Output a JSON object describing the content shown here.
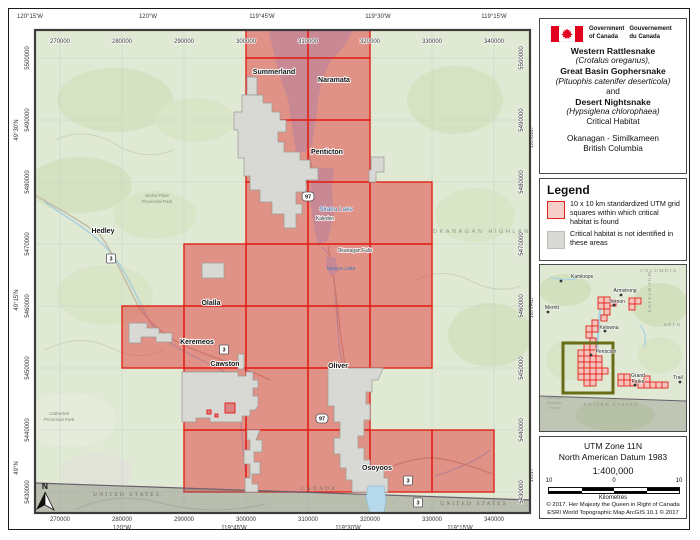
{
  "header": {
    "gov_en_1": "Government",
    "gov_en_2": "of Canada",
    "gov_fr_1": "Gouvernement",
    "gov_fr_2": "du Canada"
  },
  "title": {
    "lines": [
      "Western Rattlesnake",
      "(Crotalus oreganus),",
      "Great Basin Gophersnake",
      "(Pituophis catenifer deserticola)",
      "and",
      "Desert Nightsnake",
      "(Hypsiglena chlorophaea)",
      "Critical Habitat",
      "Okanagan - Similkameen",
      "British Columbia"
    ]
  },
  "legend": {
    "heading": "Legend",
    "item1": "10 x 10 km standardized UTM grid squares within which critical habitat is found",
    "item2": "Critical habitat is not identified in these areas"
  },
  "projection": {
    "line1": "UTM Zone 11N",
    "line2": "North American Datum 1983",
    "scale": "1:400,000",
    "scale_left": "10",
    "scale_mid": "0",
    "scale_right": "10",
    "scale_unit": "Kilometres",
    "copyright1": "© 2017. Her Majesty the Queen in Right of Canada",
    "copyright2": "ESRI World Topographic Map ArcGIS 10.1 © 2017"
  },
  "map": {
    "eastings": [
      "270000",
      "280000",
      "290000",
      "300000",
      "310000",
      "320000",
      "330000",
      "340000"
    ],
    "northings": [
      "5500000",
      "5490000",
      "5480000",
      "5470000",
      "5460000",
      "5450000",
      "5440000",
      "5430000"
    ],
    "lons_top": [
      "120°15'W",
      "120°W",
      "119°45'W",
      "119°30'W",
      "119°15'W"
    ],
    "lons_bottom": [
      "120°W",
      "119°45'W",
      "119°30'W",
      "119°15'W"
    ],
    "lats": [
      "49°30'N",
      "49°15'N",
      "49°N"
    ],
    "places": {
      "summerland": "Summerland",
      "naramata": "Naramata",
      "penticton": "Penticton",
      "hedley": "Hedley",
      "olalla": "Olalla",
      "keremeos": "Keremeos",
      "cawston": "Cawston",
      "oliver": "Oliver",
      "osoyoos": "Osoyoos",
      "kaleden": "Kaleden",
      "okfalls": "Okanagan Falls"
    },
    "lakes": {
      "skaha": "Skaha Lake",
      "vaseux": "Vaseux Lake"
    },
    "region_label": "OKANAGAN HIGHLAND",
    "parks": {
      "nickel_1": "Nickel Plate",
      "nickel_2": "Provincial Park",
      "cathedral_1": "Cathedral",
      "cathedral_2": "Provincial Park"
    },
    "border": {
      "canada": "CANADA",
      "united_states": "UNITED STATES"
    },
    "shield3": "3",
    "shield97": "97",
    "north_label": "N"
  },
  "inset": {
    "cities": {
      "kamloops": "Kamloops",
      "armstrong": "Armstrong",
      "vernon": "Vernon",
      "merritt": "Merritt",
      "kelowna": "Kelowna",
      "penticton": "Penticton",
      "grand_forks_1": "Grand",
      "grand_forks_2": "Forks",
      "trail": "Trail"
    },
    "labels": {
      "columbia": "COLUMBIA",
      "mountains": "MOUNTAINS",
      "selkirk": "SELK",
      "united_states": "UNITED STATES",
      "forest_1": "Okanogan",
      "forest_2": "National",
      "forest_3": "Forest"
    }
  },
  "colors": {
    "grid_red": "#E2231A",
    "habitat_overlay": "rgba(227,26,28,0.45)",
    "not_identified_gray": "#D8D8D5",
    "extent_olive": "#6A6D18",
    "flag_red": "#E3001F",
    "topo_green": "#E0E9D4",
    "lake_blue": "#B5D8EA"
  }
}
